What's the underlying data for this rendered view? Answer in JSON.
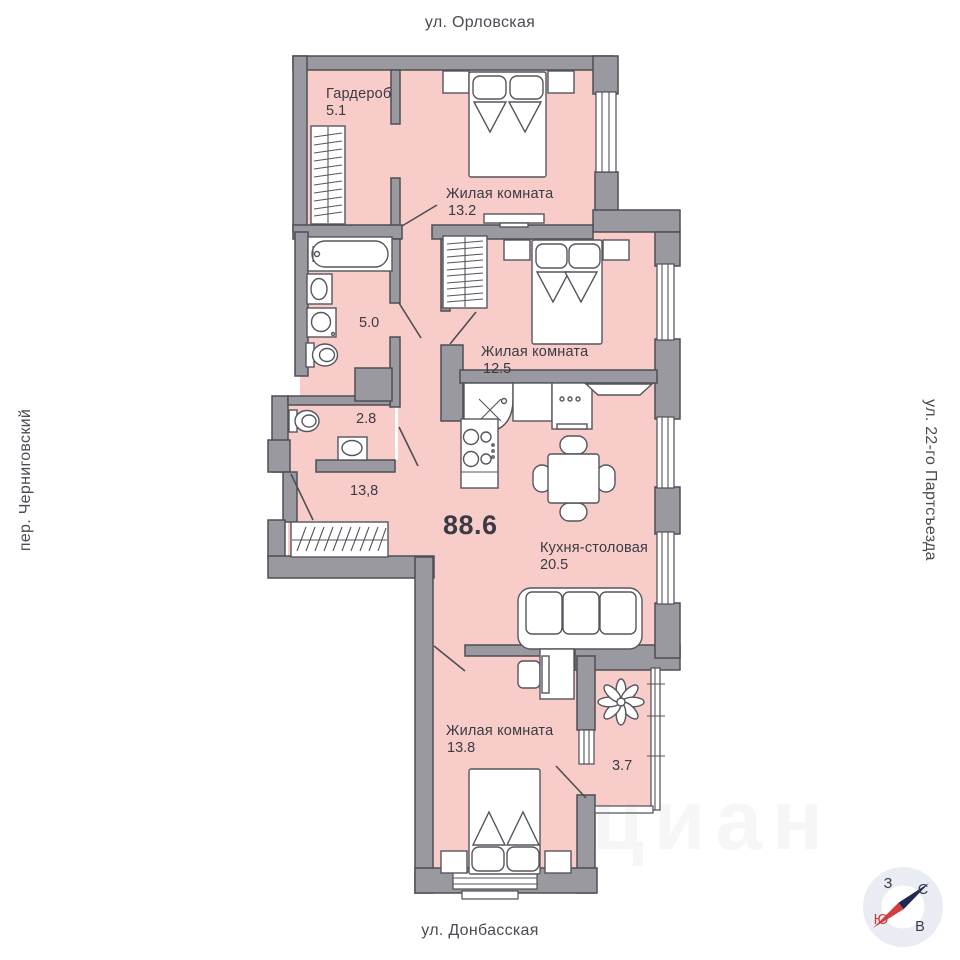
{
  "streets": {
    "top": "ул. Орловская",
    "bottom": "ул. Донбасская",
    "left": "пер. Черниговский",
    "right": "ул. 22-го Партсъезда"
  },
  "total_area": "88.6",
  "rooms": {
    "wardrobe": {
      "name": "Гардероб",
      "area": "5.1"
    },
    "bedroom_top": {
      "name": "Жилая комната",
      "area": "13.2"
    },
    "bathroom": {
      "area": "5.0"
    },
    "bedroom_mid": {
      "name": "Жилая комната",
      "area": "12.5"
    },
    "wc": {
      "area": "2.8"
    },
    "hallway": {
      "area": "13,8"
    },
    "kitchen": {
      "name": "Кухня-столовая",
      "area": "20.5"
    },
    "bedroom_bottom": {
      "name": "Жилая комната",
      "area": "13.8"
    },
    "balcony": {
      "area": "3.7"
    }
  },
  "compass": {
    "north": "С",
    "south": "Ю",
    "west": "З",
    "east": "В"
  },
  "watermark": "циан",
  "colors": {
    "room_fill": "#F8CDC9",
    "wall_fill": "#9A999F",
    "wall_outline": "#4E4E56",
    "furniture_outline": "#55555D",
    "label_text": "#3A3A44",
    "compass_circle": "#E9ECF3",
    "compass_south_letter": "#CC3B39",
    "compass_needle_north": "#1F2A52",
    "compass_needle_south": "#D13F3C"
  }
}
